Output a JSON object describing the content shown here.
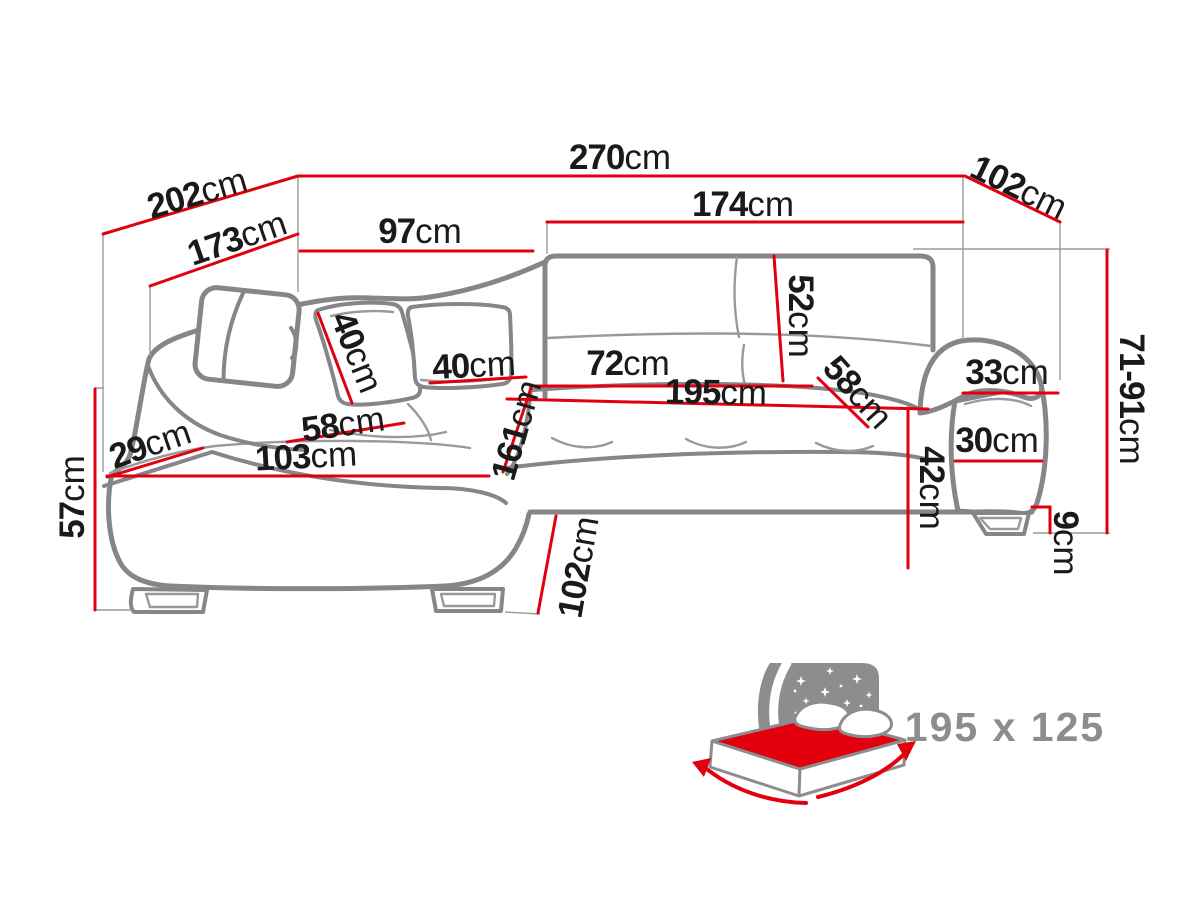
{
  "colors": {
    "dimension_red": "#e2000f",
    "sofa_outline_gray": "#85858a",
    "icon_gray": "#8d8d8d",
    "label_black": "#1a1a1a"
  },
  "dims": {
    "d270": {
      "v": "270",
      "u": "cm"
    },
    "d202": {
      "v": "202",
      "u": "cm"
    },
    "d173": {
      "v": "173",
      "u": "cm"
    },
    "d102": {
      "v": "102",
      "u": "cm"
    },
    "d174": {
      "v": "174",
      "u": "cm"
    },
    "d97": {
      "v": "97",
      "u": "cm"
    },
    "d52": {
      "v": "52",
      "u": "cm"
    },
    "d40a": {
      "v": "40",
      "u": "cm"
    },
    "d40b": {
      "v": "40",
      "u": "cm"
    },
    "d72": {
      "v": "72",
      "u": "cm"
    },
    "d195": {
      "v": "195",
      "u": "cm"
    },
    "d58r": {
      "v": "58",
      "u": "cm"
    },
    "d33": {
      "v": "33",
      "u": "cm"
    },
    "d30": {
      "v": "30",
      "u": "cm"
    },
    "d7191": {
      "v": "71-91",
      "u": "cm"
    },
    "d9": {
      "v": "9",
      "u": "cm"
    },
    "d42": {
      "v": "42",
      "u": "cm"
    },
    "d57": {
      "v": "57",
      "u": "cm"
    },
    "d29": {
      "v": "29",
      "u": "cm"
    },
    "d103": {
      "v": "103",
      "u": "cm"
    },
    "d58l": {
      "v": "58",
      "u": "cm"
    },
    "d161": {
      "v": "161",
      "u": "cm"
    },
    "d102b": {
      "v": "102",
      "u": "cm"
    }
  },
  "bed_icon": {
    "name": "sofa-bed-sleep-function-icon",
    "size_label": "195 x 125"
  }
}
